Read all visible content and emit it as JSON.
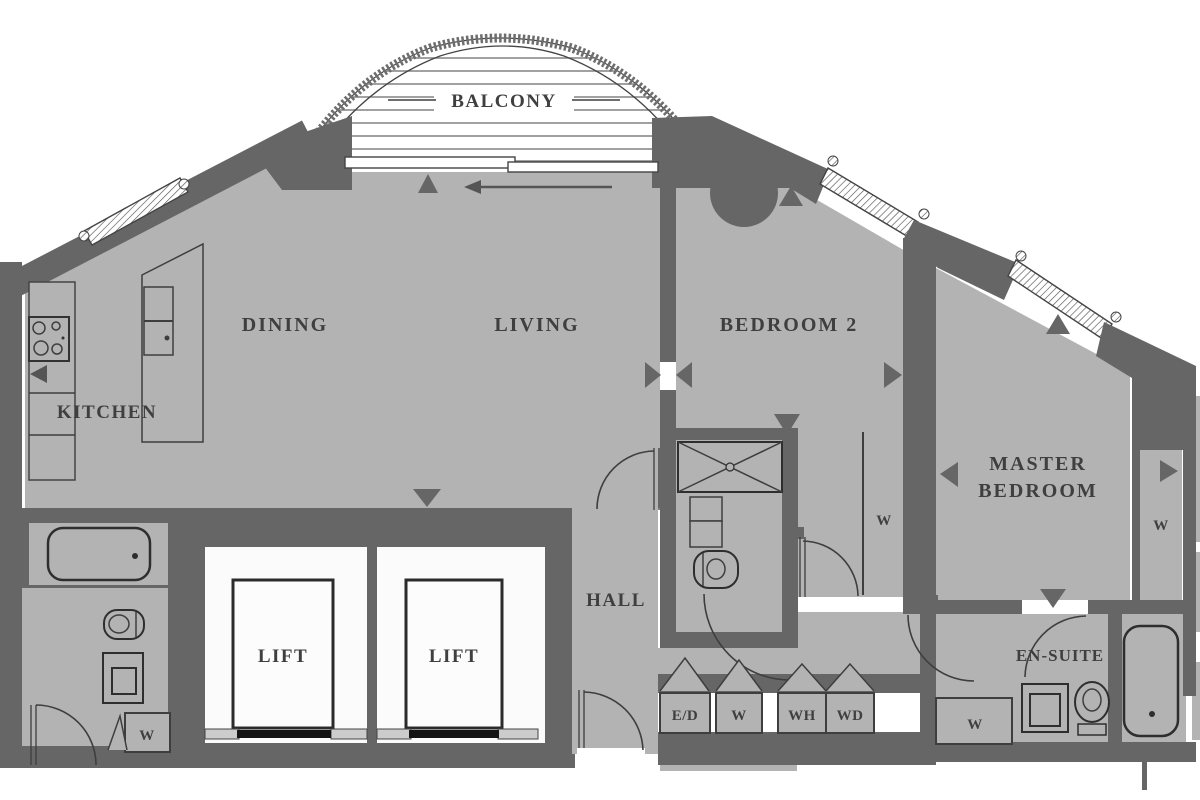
{
  "plan": {
    "title": "apartment floor plan",
    "labels": {
      "balcony": "BALCONY",
      "dining": "DINING",
      "living": "LIVING",
      "kitchen": "KITCHEN",
      "bedroom2": "BEDROOM 2",
      "master_line1": "MASTER",
      "master_line2": "BEDROOM",
      "hall": "HALL",
      "lift1": "LIFT",
      "lift2": "LIFT",
      "ensuite": "EN-SUITE",
      "closet_ed": "E/D",
      "closet_w_hall": "W",
      "closet_wh": "WH",
      "closet_wd": "WD",
      "closet_w_bedroom2": "W",
      "closet_w_master": "W",
      "closet_w_ensuite": "W",
      "closet_w_bathroom": "W"
    },
    "colors": {
      "wall": "#666666",
      "floor": "#b3b3b3",
      "line": "#3e3e3e",
      "background": "#ffffff",
      "lift_floor": "#fbfbfb"
    }
  }
}
